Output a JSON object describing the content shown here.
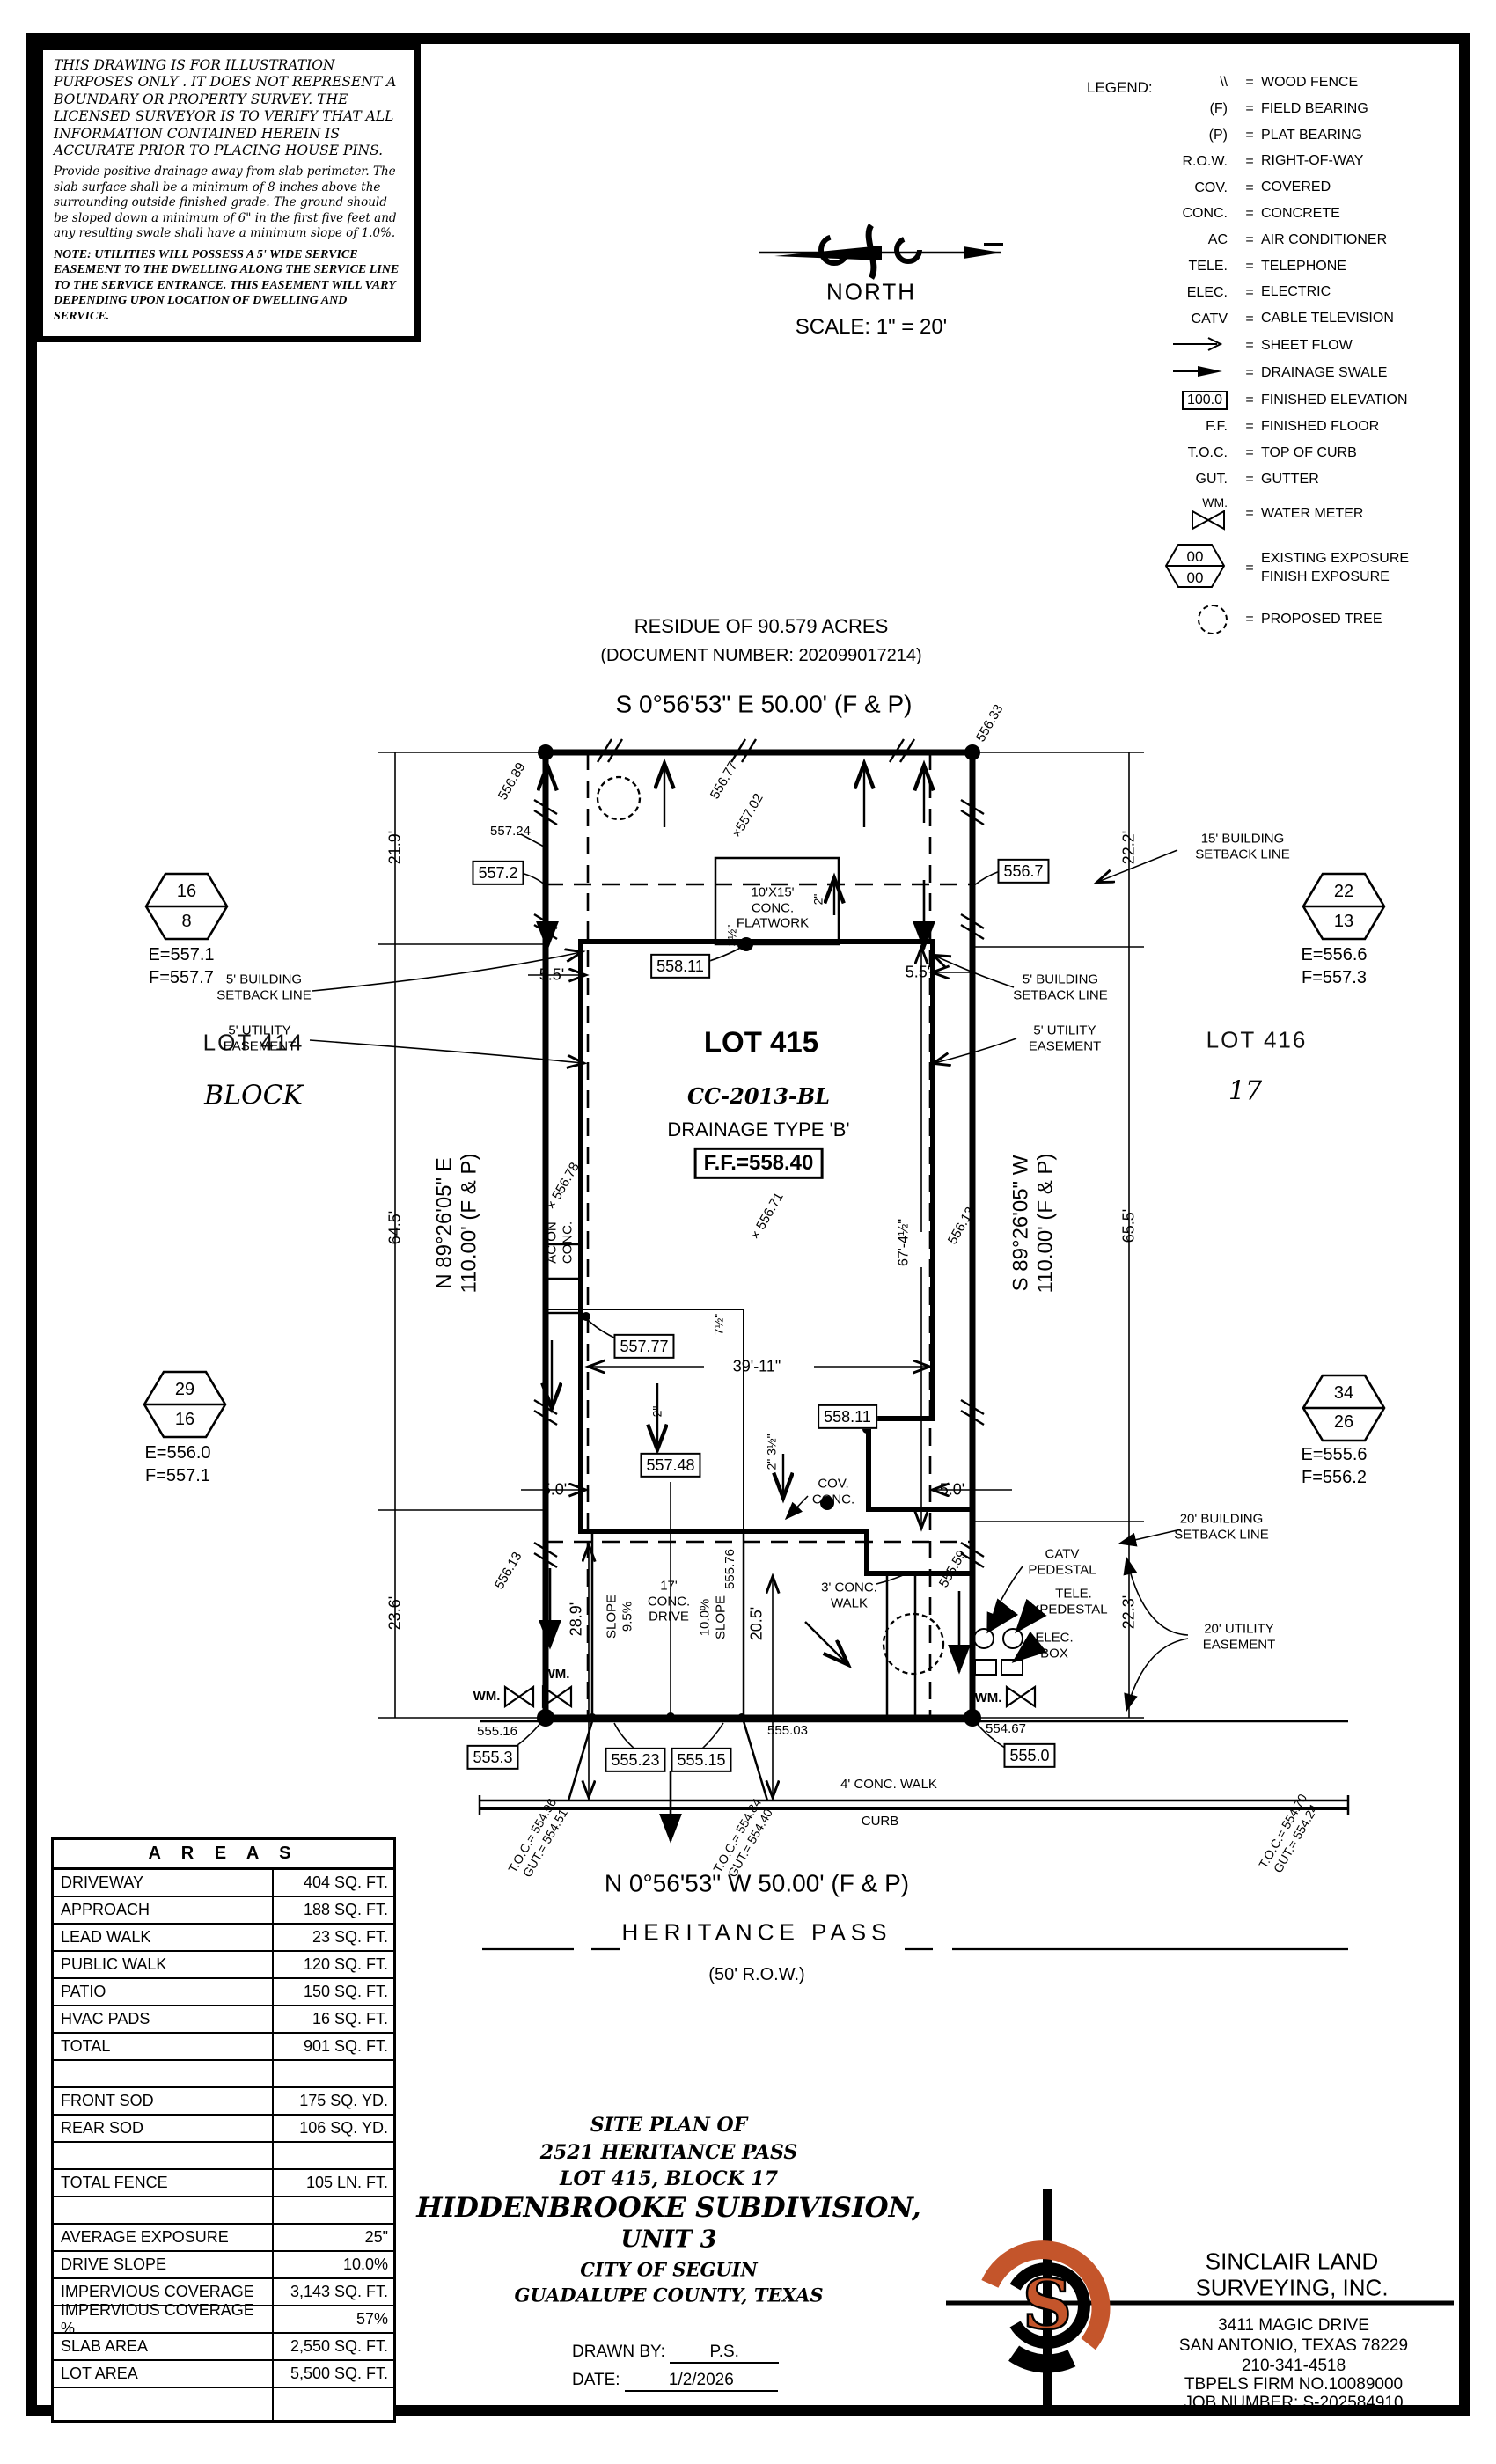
{
  "colors": {
    "ink": "#000000",
    "accent": "#c4552b",
    "paper": "#ffffff"
  },
  "notes": {
    "disclaimer": "THIS DRAWING IS FOR ILLUSTRATION PURPOSES ONLY . IT DOES NOT REPRESENT A BOUNDARY OR PROPERTY SURVEY. THE LICENSED SURVEYOR IS TO VERIFY THAT ALL INFORMATION CONTAINED HEREIN IS ACCURATE PRIOR TO PLACING HOUSE PINS.",
    "drainage": "Provide positive drainage away from slab perimeter. The slab surface shall be a minimum of 8 inches above the surrounding outside finished grade. The ground should be sloped down a minimum of 6\" in the first five feet and any resulting swale shall have a minimum slope of 1.0%.",
    "utilities": "NOTE: UTILITIES WILL POSSESS A 5' WIDE SERVICE EASEMENT TO THE DWELLING ALONG THE SERVICE LINE TO THE SERVICE ENTRANCE. THIS EASEMENT WILL VARY DEPENDING UPON LOCATION OF DWELLING AND SERVICE."
  },
  "north": {
    "label": "NORTH",
    "scale": "SCALE: 1\" = 20'"
  },
  "legend": {
    "title": "LEGEND:",
    "eq": "=",
    "items": [
      {
        "key": "\\\\",
        "label": "WOOD FENCE"
      },
      {
        "key": "(F)",
        "label": "FIELD BEARING"
      },
      {
        "key": "(P)",
        "label": "PLAT BEARING"
      },
      {
        "key": "R.O.W.",
        "label": "RIGHT-OF-WAY"
      },
      {
        "key": "COV.",
        "label": "COVERED"
      },
      {
        "key": "CONC.",
        "label": "CONCRETE"
      },
      {
        "key": "AC",
        "label": "AIR CONDITIONER"
      },
      {
        "key": "TELE.",
        "label": "TELEPHONE"
      },
      {
        "key": "ELEC.",
        "label": "ELECTRIC"
      },
      {
        "key": "CATV",
        "label": "CABLE TELEVISION"
      },
      {
        "key": "",
        "label": "SHEET FLOW"
      },
      {
        "key": "",
        "label": "DRAINAGE SWALE"
      },
      {
        "key": "100.0",
        "label": "FINISHED ELEVATION"
      },
      {
        "key": "F.F.",
        "label": "FINISHED FLOOR"
      },
      {
        "key": "T.O.C.",
        "label": "TOP OF CURB"
      },
      {
        "key": "GUT.",
        "label": "GUTTER"
      },
      {
        "key": "WM.",
        "label": "WATER METER"
      },
      {
        "top": "00",
        "bot": "00",
        "label": "EXISTING EXPOSURE\nFINISH EXPOSURE"
      },
      {
        "key": "",
        "label": "PROPOSED TREE"
      }
    ]
  },
  "residue": {
    "line1": "RESIDUE OF 90.579  ACRES",
    "line2": "(DOCUMENT NUMBER: 202099017214)"
  },
  "plan": {
    "brg_top": "S 0°56'53\" E 50.00' (F & P)",
    "brg_bottom": "N 0°56'53\" W 50.00' (F & P)",
    "brg_left": "N 89°26'05\" E\n110.00' (F & P)",
    "brg_right": "S 89°26'05\" W\n110.00' (F & P)",
    "street_name": "HERITANCE PASS",
    "street_row": "(50' R.O.W.)",
    "lot_label": "LOT 415",
    "lot_plan": "CC-2013-BL",
    "lot_drain": "DRAINAGE TYPE 'B'",
    "lot_ff": "F.F.=558.40",
    "lot414": "LOT 414",
    "block_word": "BLOCK",
    "lot416": "LOT 416",
    "block_num": "17",
    "sb15": "15' BUILDING\nSETBACK LINE",
    "sb5l": "5' BUILDING\nSETBACK LINE",
    "ue5l": "5' UTILITY\nEASEMENT",
    "sb5r": "5' BUILDING\nSETBACK LINE",
    "ue5r": "5' UTILITY\nEASEMENT",
    "sb20": "20' BUILDING\nSETBACK LINE",
    "ue20": "20' UTILITY\nEASEMENT",
    "flatwork": "10'X15'\nCONC.\nFLATWORK",
    "ac": "AC ON\nCONC.",
    "cov": "COV.\nCONC.",
    "drive17": "17'\nCONC.\nDRIVE",
    "slope95": "SLOPE\n9.5%",
    "slope10": "10.0%\nSLOPE",
    "walk3": "3' CONC.\nWALK",
    "walk4": "4' CONC. WALK",
    "curb": "CURB",
    "wm": "WM.",
    "catv": "CATV\nPEDESTAL",
    "tele": "TELE.\nPEDESTAL",
    "elec": "ELEC.\nBOX",
    "d219": "21.9'",
    "d222": "22.2'",
    "d645": "64.5'",
    "d655": "65.5'",
    "d236": "23.6'",
    "d223": "22.3'",
    "d289": "28.9'",
    "d205": "20.5'",
    "d3911": "39'-11\"",
    "d674": "67'-4½\"",
    "d55": "5.5'",
    "d50": "5.0'",
    "d75": "7½\"",
    "d2": "2\"",
    "d235": "2\" 3½\"",
    "d35": "3½\"",
    "e55633": "556.33",
    "e55689": "556.89",
    "e55677": "556.77",
    "e55702": "×557.02",
    "e55724": "557.24",
    "e5572": "557.2",
    "e5567": "556.7",
    "e55811": "558.11",
    "e55777": "557.77",
    "e55748": "557.48",
    "e55678": "× 556.78",
    "e55671": "× 556.71",
    "e55613": "556.13",
    "e55559": "555.59",
    "e55576": "555.76",
    "e55516": "555.16",
    "e5553": "555.3",
    "e55523": "555.23",
    "e55515": "555.15",
    "e55503": "555.03",
    "e55467": "554.67",
    "e5550": "555.0",
    "toc1": "T.O.C.= 554.96\nGUT.= 554.51",
    "toc2": "T.O.C.= 554.84\nGUT.= 554.40",
    "toc3": "T.O.C.= 554.70\nGUT.= 554.24"
  },
  "hex": {
    "nw": {
      "top": "16",
      "bot": "8",
      "e": "E=557.1",
      "f": "F=557.7"
    },
    "ne": {
      "top": "22",
      "bot": "13",
      "e": "E=556.6",
      "f": "F=557.3"
    },
    "sw": {
      "top": "29",
      "bot": "16",
      "e": "E=556.0",
      "f": "F=557.1"
    },
    "se": {
      "top": "34",
      "bot": "26",
      "e": "E=555.6",
      "f": "F=556.2"
    }
  },
  "areas": {
    "title": "A R E A S",
    "rows": [
      {
        "label": "DRIVEWAY",
        "value": "404 SQ. FT."
      },
      {
        "label": "APPROACH",
        "value": "188 SQ. FT."
      },
      {
        "label": "LEAD WALK",
        "value": "23 SQ. FT."
      },
      {
        "label": "PUBLIC WALK",
        "value": "120 SQ. FT."
      },
      {
        "label": "PATIO",
        "value": "150 SQ. FT."
      },
      {
        "label": "HVAC PADS",
        "value": "16 SQ. FT."
      },
      {
        "label": "TOTAL",
        "value": "901 SQ. FT."
      },
      {
        "label": "",
        "value": ""
      },
      {
        "label": "FRONT SOD",
        "value": "175 SQ. YD."
      },
      {
        "label": "REAR SOD",
        "value": "106 SQ. YD."
      },
      {
        "label": "",
        "value": ""
      },
      {
        "label": "TOTAL FENCE",
        "value": "105 LN. FT."
      },
      {
        "label": "",
        "value": ""
      },
      {
        "label": "AVERAGE EXPOSURE",
        "value": "25\""
      },
      {
        "label": "DRIVE SLOPE",
        "value": "10.0%"
      },
      {
        "label": "IMPERVIOUS COVERAGE",
        "value": "3,143 SQ. FT."
      },
      {
        "label": "IMPERVIOUS COVERAGE %",
        "value": "57%"
      },
      {
        "label": "SLAB AREA",
        "value": "2,550 SQ. FT."
      },
      {
        "label": "LOT AREA",
        "value": "5,500 SQ. FT."
      },
      {
        "label": "",
        "value": ""
      }
    ]
  },
  "titleblock": {
    "l1": "SITE PLAN OF",
    "l2": "2521 HERITANCE PASS",
    "l3": "LOT 415, BLOCK 17",
    "l4": "HIDDENBROOKE SUBDIVISION,",
    "l5": "UNIT 3",
    "l6": "CITY OF SEGUIN",
    "l7": "GUADALUPE COUNTY, TEXAS",
    "drawn_label": "DRAWN BY:",
    "drawn": "P.S.",
    "date_label": "DATE:",
    "date": "1/2/2026"
  },
  "company": {
    "name1": "SINCLAIR LAND",
    "name2": "SURVEYING, INC.",
    "addr1": "3411 MAGIC DRIVE",
    "addr2": "SAN ANTONIO, TEXAS 78229",
    "phone": "210-341-4518",
    "firm": "TBPELS FIRM NO.10089000",
    "job": "JOB NUMBER: S-202584910",
    "logo_letter": "S"
  }
}
